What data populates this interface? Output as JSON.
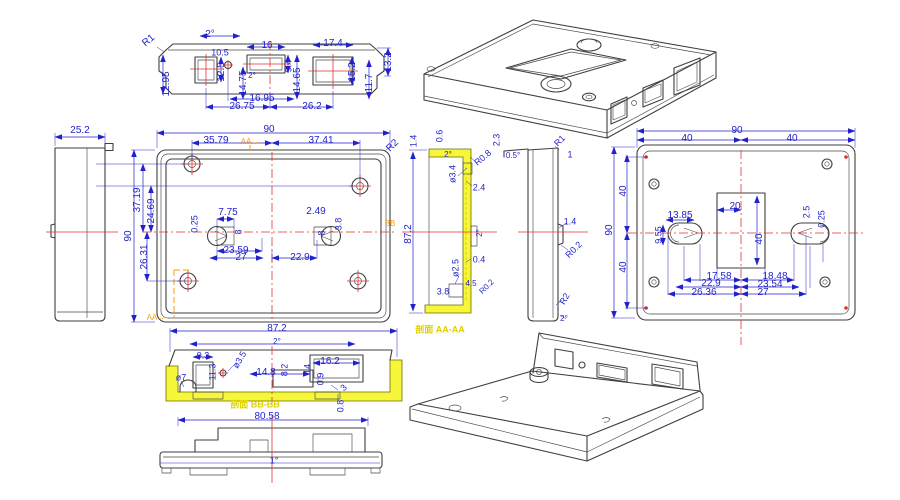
{
  "drawing": {
    "type": "engineering-cad-drawing",
    "section_caption_aa": "剖面 AA-AA",
    "section_caption_bb": "剖面 BB-BB"
  },
  "colors": {
    "dim": "#2222cc",
    "geom": "#3f3f3f",
    "center": "#e03333",
    "marker": "#ff9d00",
    "highlight": "#f6f63a",
    "section_label": "#e0d000",
    "background": "#ffffff"
  },
  "views": [
    {
      "id": "top-view",
      "labels": [
        {
          "t": "R1",
          "x": 149,
          "y": 41,
          "r": -40
        },
        {
          "t": "2°",
          "x": 210,
          "y": 35
        },
        {
          "t": "10.5",
          "x": 220,
          "y": 53,
          "fs": 9
        },
        {
          "t": "16",
          "x": 267,
          "y": 46
        },
        {
          "t": "17.4",
          "x": 333,
          "y": 44
        },
        {
          "t": "13.2",
          "x": 389,
          "y": 62,
          "r": -90
        },
        {
          "t": "12.95",
          "x": 167,
          "y": 84,
          "r": -90
        },
        {
          "t": "12.5",
          "x": 222,
          "y": 72,
          "r": -90
        },
        {
          "t": "14.75",
          "x": 244,
          "y": 83,
          "r": -90
        },
        {
          "t": "2°",
          "x": 252,
          "y": 76,
          "fs": 8
        },
        {
          "t": "9.4",
          "x": 289,
          "y": 66,
          "r": -90,
          "fs": 9
        },
        {
          "t": "14.65",
          "x": 298,
          "y": 80,
          "r": -90
        },
        {
          "t": "15.2",
          "x": 353,
          "y": 72,
          "r": -90
        },
        {
          "t": "11.7",
          "x": 370,
          "y": 83,
          "r": -90
        },
        {
          "t": "16.95",
          "x": 262,
          "y": 99
        },
        {
          "t": "26.75",
          "x": 242,
          "y": 107
        },
        {
          "t": "26.2",
          "x": 312,
          "y": 107
        }
      ]
    },
    {
      "id": "side-left-view",
      "labels": [
        {
          "t": "25.2",
          "x": 80,
          "y": 131
        }
      ]
    },
    {
      "id": "front-view",
      "labels": [
        {
          "t": "90",
          "x": 269,
          "y": 130
        },
        {
          "t": "35.79",
          "x": 216,
          "y": 141
        },
        {
          "t": "AA→",
          "x": 250,
          "y": 142,
          "c": "marker",
          "fs": 8
        },
        {
          "t": "37.41",
          "x": 321,
          "y": 141
        },
        {
          "t": "R2",
          "x": 393,
          "y": 146,
          "r": -45
        },
        {
          "t": "90",
          "x": 129,
          "y": 236,
          "r": -90
        },
        {
          "t": "37.19",
          "x": 138,
          "y": 200,
          "r": -90
        },
        {
          "t": "24.69",
          "x": 152,
          "y": 211,
          "r": -90
        },
        {
          "t": "26.31",
          "x": 145,
          "y": 257,
          "r": -90
        },
        {
          "t": "0.25",
          "x": 195,
          "y": 224,
          "r": -90,
          "fs": 9
        },
        {
          "t": "7.75",
          "x": 228,
          "y": 213
        },
        {
          "t": "8",
          "x": 239,
          "y": 232,
          "r": -90,
          "fs": 9
        },
        {
          "t": "23.59",
          "x": 236,
          "y": 251
        },
        {
          "t": "27",
          "x": 241,
          "y": 258
        },
        {
          "t": "22.9",
          "x": 300,
          "y": 258
        },
        {
          "t": "2.49",
          "x": 316,
          "y": 212
        },
        {
          "t": "3.8",
          "x": 339,
          "y": 224,
          "r": -90,
          "fs": 9
        },
        {
          "t": "8",
          "x": 322,
          "y": 233,
          "r": -90,
          "fs": 9
        },
        {
          "t": "BB",
          "x": 390,
          "y": 224,
          "c": "marker",
          "fs": 8
        },
        {
          "t": "AA→",
          "x": 156,
          "y": 318,
          "c": "marker",
          "fs": 8
        }
      ]
    },
    {
      "id": "section-aa-view",
      "labels": [
        {
          "t": "1.4",
          "x": 414,
          "y": 141,
          "r": -90,
          "fs": 9
        },
        {
          "t": "0.6",
          "x": 440,
          "y": 136,
          "r": -90,
          "fs": 9
        },
        {
          "t": "2°",
          "x": 448,
          "y": 155,
          "fs": 8
        },
        {
          "t": "ø3.4",
          "x": 453,
          "y": 174,
          "r": -90,
          "fs": 9
        },
        {
          "t": "R0.8",
          "x": 483,
          "y": 158,
          "r": -40,
          "fs": 9
        },
        {
          "t": "2.4",
          "x": 479,
          "y": 188,
          "fs": 9
        },
        {
          "t": "2.3",
          "x": 497,
          "y": 140,
          "r": -90,
          "fs": 9
        },
        {
          "t": "0.5°",
          "x": 513,
          "y": 156,
          "fs": 8
        },
        {
          "t": "87.2",
          "x": 409,
          "y": 234,
          "r": -90
        },
        {
          "t": "2°",
          "x": 480,
          "y": 233,
          "r": -90,
          "fs": 8
        },
        {
          "t": "0.4",
          "x": 479,
          "y": 260,
          "fs": 9
        },
        {
          "t": "ø2.5",
          "x": 456,
          "y": 268,
          "r": -90,
          "fs": 9
        },
        {
          "t": "4.5",
          "x": 471,
          "y": 284,
          "fs": 8
        },
        {
          "t": "R0.2",
          "x": 487,
          "y": 287,
          "r": -45,
          "fs": 8
        },
        {
          "t": "3.8",
          "x": 443,
          "y": 292,
          "fs": 9
        },
        {
          "t": "剖面 AA-AA",
          "x": 440,
          "y": 330,
          "c": "section_label",
          "fs": 9,
          "b": 1
        }
      ]
    },
    {
      "id": "side-mid-view",
      "labels": [
        {
          "t": "R1",
          "x": 560,
          "y": 141,
          "r": -45,
          "fs": 9
        },
        {
          "t": "1",
          "x": 570,
          "y": 155,
          "fs": 9
        },
        {
          "t": "1.4",
          "x": 570,
          "y": 222,
          "fs": 9
        },
        {
          "t": "R0.2",
          "x": 574,
          "y": 250,
          "r": -45,
          "fs": 9
        },
        {
          "t": "R2",
          "x": 565,
          "y": 299,
          "r": -60,
          "fs": 9
        },
        {
          "t": "2°",
          "x": 564,
          "y": 319,
          "fs": 8
        }
      ]
    },
    {
      "id": "back-view",
      "labels": [
        {
          "t": "90",
          "x": 737,
          "y": 131
        },
        {
          "t": "40",
          "x": 687,
          "y": 139
        },
        {
          "t": "40",
          "x": 792,
          "y": 139
        },
        {
          "t": "90",
          "x": 610,
          "y": 230,
          "r": -90
        },
        {
          "t": "40",
          "x": 624,
          "y": 191,
          "r": -90
        },
        {
          "t": "40",
          "x": 624,
          "y": 267,
          "r": -90
        },
        {
          "t": "20",
          "x": 735,
          "y": 207
        },
        {
          "t": "40",
          "x": 760,
          "y": 239,
          "r": -90
        },
        {
          "t": "13.85",
          "x": 680,
          "y": 216
        },
        {
          "t": "9.55",
          "x": 659,
          "y": 235,
          "r": -90,
          "fs": 9
        },
        {
          "t": "2.5",
          "x": 807,
          "y": 212,
          "r": -90,
          "fs": 9
        },
        {
          "t": "0.25",
          "x": 822,
          "y": 219,
          "r": -90,
          "fs": 9
        },
        {
          "t": "17.58",
          "x": 719,
          "y": 277
        },
        {
          "t": "18.48",
          "x": 775,
          "y": 277
        },
        {
          "t": "22.9",
          "x": 711,
          "y": 284
        },
        {
          "t": "23.54",
          "x": 770,
          "y": 285
        },
        {
          "t": "26.36",
          "x": 704,
          "y": 293
        },
        {
          "t": "27",
          "x": 763,
          "y": 293
        }
      ]
    },
    {
      "id": "section-bb-view",
      "labels": [
        {
          "t": "87.2",
          "x": 277,
          "y": 329
        },
        {
          "t": "2°",
          "x": 277,
          "y": 342,
          "fs": 8
        },
        {
          "t": "9.3",
          "x": 203,
          "y": 356,
          "fs": 9
        },
        {
          "t": "11.3",
          "x": 213,
          "y": 372,
          "r": -90,
          "fs": 9
        },
        {
          "t": "ø3.5",
          "x": 240,
          "y": 360,
          "r": -60,
          "fs": 9
        },
        {
          "t": "ø7",
          "x": 181,
          "y": 378,
          "fs": 9
        },
        {
          "t": "14.8",
          "x": 266,
          "y": 373
        },
        {
          "t": "8.2",
          "x": 285,
          "y": 370,
          "r": -90,
          "fs": 9
        },
        {
          "t": "14",
          "x": 308,
          "y": 369,
          "r": -90,
          "fs": 9
        },
        {
          "t": "16.2",
          "x": 330,
          "y": 362
        },
        {
          "t": "0.9",
          "x": 321,
          "y": 379,
          "r": -90,
          "fs": 9
        },
        {
          "t": "3",
          "x": 344,
          "y": 388,
          "r": -45,
          "fs": 9
        },
        {
          "t": "0.8",
          "x": 341,
          "y": 406,
          "r": -90,
          "fs": 9
        },
        {
          "t": "剖面 BB-BB",
          "x": 255,
          "y": 405,
          "c": "section_label",
          "fs": 9,
          "b": 1
        }
      ]
    },
    {
      "id": "bottom-front-view",
      "labels": [
        {
          "t": "80.58",
          "x": 267,
          "y": 417
        },
        {
          "t": "1°",
          "x": 274,
          "y": 461,
          "fs": 9
        }
      ]
    },
    {
      "id": "iso-top-view",
      "labels": []
    },
    {
      "id": "iso-bottom-view",
      "labels": []
    }
  ]
}
